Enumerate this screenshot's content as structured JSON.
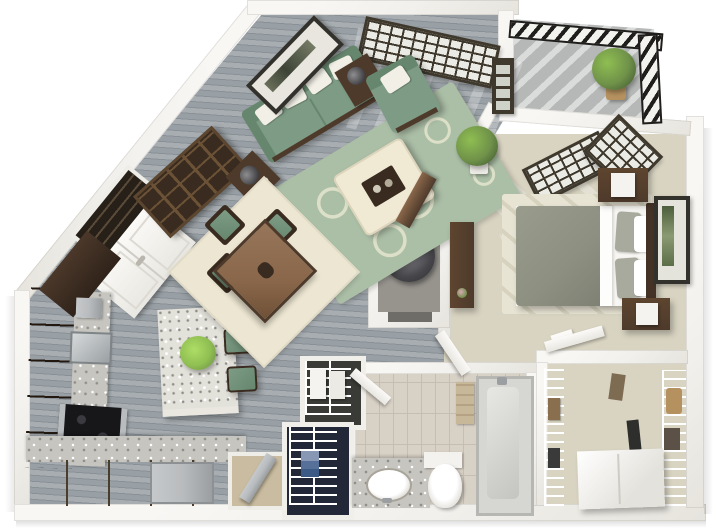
{
  "scene": {
    "type": "3d-floor-plan-render",
    "description": "Isometric 3D dollhouse floor plan of a one-bedroom apartment with angled entry wall",
    "rooms": [
      {
        "id": "living-room",
        "furniture": [
          "green-sofa",
          "throw-pillows",
          "green-armchair",
          "cream-ottoman-coffee-table",
          "green-damask-area-rug",
          "bookshelf",
          "side-table-lamps",
          "framed-wall-art",
          "console-table",
          "potted-floor-plant"
        ]
      },
      {
        "id": "dining-area",
        "furniture": [
          "square-wood-table",
          "four-chairs-green-cushions",
          "cream-rug",
          "centerpiece"
        ]
      },
      {
        "id": "kitchen",
        "furniture": [
          "l-shaped-espresso-cabinets",
          "granite-counters",
          "island-with-plant",
          "two-green-bar-stools",
          "black-cooktop",
          "steel-sink",
          "dishwasher",
          "pantry-shelves",
          "white-double-entry-door"
        ]
      },
      {
        "id": "bedroom",
        "furniture": [
          "bed-gray-duvet",
          "two-nightstands",
          "white-cube-lamps",
          "dark-headboard",
          "tall-dresser",
          "framed-botanical-art",
          "corner-windows",
          "pale-rug"
        ]
      },
      {
        "id": "bathroom",
        "furniture": [
          "granite-vanity-oval-sink",
          "toilet",
          "bathtub-shower",
          "towels",
          "tiled-floor"
        ]
      },
      {
        "id": "walk-in-closet",
        "furniture": [
          "white-wire-shelving",
          "hanging-clothes",
          "white-dresser"
        ]
      },
      {
        "id": "balcony",
        "furniture": [
          "potted-plant",
          "black-diagonal-slat-railing",
          "concrete-floor"
        ]
      },
      {
        "id": "utility-closet",
        "furniture": [
          "water-heater"
        ]
      },
      {
        "id": "hall-closets",
        "furniture": [
          "basket-shelf-closet",
          "dark-linen-closet",
          "ironing-nook"
        ]
      }
    ]
  },
  "palette": {
    "wall": "#f2f0ec",
    "wallEdge": "#d8d5ce",
    "floorA": "#a7adb1",
    "floorB": "#99a0a5",
    "plankLine": "#8a9196",
    "carpet": "#d9d4c2",
    "carpetLight": "#e8e4d4",
    "tile": "#d8d1c6",
    "tileLine": "#c6beb2",
    "balconyFloor": "#b5b8b6",
    "railDark": "#1f1e1c",
    "railLight": "#f2f2ee",
    "espresso": "#4b382a",
    "espressoDark": "#30231a",
    "khaki": "#75634a",
    "granite": "#c6c5bf",
    "graniteDot": "#8f8e88",
    "islandTop": "#e2e1da",
    "steel": "#b9bcbe",
    "sofa": "#7e9c85",
    "sofaDark": "#66866e",
    "pillow": "#f1efe6",
    "rug": "#abbea6",
    "rugPat": "#dde0c8",
    "cream": "#ece6d2",
    "ottoman": "#f0e9d4",
    "woodMid": "#8a674a",
    "woodDark": "#4e3a2b",
    "woodDeep": "#392b1f",
    "linen": "#f7f6f2",
    "duvet": "#8d9081",
    "pillowGray": "#a9aa9e",
    "headboard": "#443226",
    "plantDark": "#4c6637",
    "plantMid": "#6f9149",
    "plantBright": "#8fbe52",
    "navy": "#222837",
    "tub": "#d6d7d2",
    "artFrame": "#33312c",
    "potTan": "#b5915f",
    "windowFrame": "#3e382d",
    "paneLight": "#eaebe5",
    "towel": "#c8b89a",
    "heater": "#47474b",
    "heaterRing": "#7a7a80"
  }
}
